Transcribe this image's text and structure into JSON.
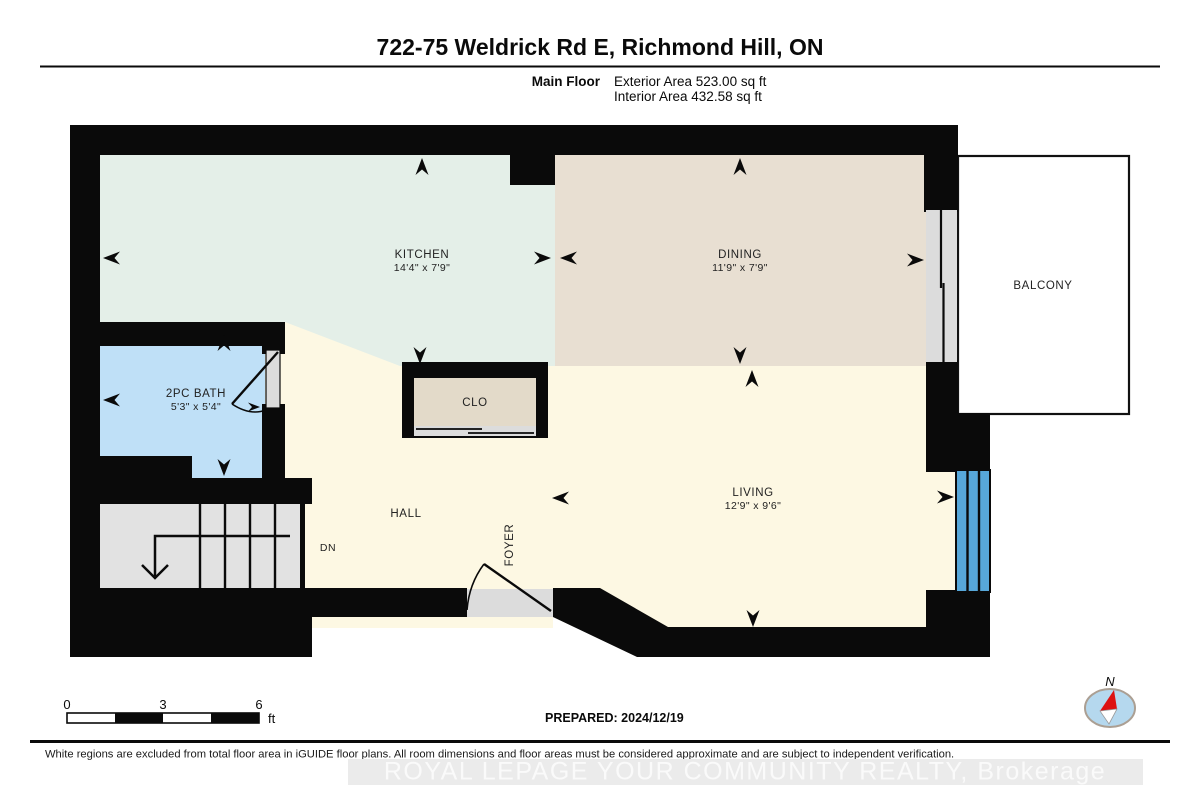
{
  "header": {
    "title": "722-75 Weldrick Rd E, Richmond Hill, ON",
    "floor_label": "Main Floor",
    "exterior_area": "Exterior Area 523.00 sq ft",
    "interior_area": "Interior Area 432.58 sq ft"
  },
  "rooms": {
    "kitchen": {
      "name": "KITCHEN",
      "dims": "14'4\" x 7'9\""
    },
    "dining": {
      "name": "DINING",
      "dims": "11'9\" x 7'9\""
    },
    "living": {
      "name": "LIVING",
      "dims": "12'9\" x 9'6\""
    },
    "bath": {
      "name": "2PC BATH",
      "dims": "5'3\" x 5'4\""
    },
    "closet": {
      "name": "CLO"
    },
    "hall": {
      "name": "HALL"
    },
    "foyer": {
      "name": "FOYER"
    },
    "balcony": {
      "name": "BALCONY"
    },
    "stairs": {
      "name": "DN"
    }
  },
  "scale_bar": {
    "tick_0": "0",
    "tick_3": "3",
    "tick_6": "6",
    "unit": "ft"
  },
  "prepared_label": "PREPARED: 2024/12/19",
  "compass_label": "N",
  "footer": {
    "disclaimer": "White regions are excluded from total floor area in iGUIDE floor plans. All room dimensions and floor areas must be considered approximate and are subject to independent verification.",
    "watermark": "ROYAL LEPAGE YOUR COMMUNITY REALTY, Brokerage"
  },
  "colors": {
    "kitchen": "#e4efe8",
    "dining": "#e8dfd2",
    "living_hall": "#fdf8e3",
    "bath": "#bfe0f7",
    "window": "#57a7d9",
    "wall": "#0a0a0a",
    "stairs": "#e2e2e2",
    "compass_fill": "#b5d8ee"
  }
}
